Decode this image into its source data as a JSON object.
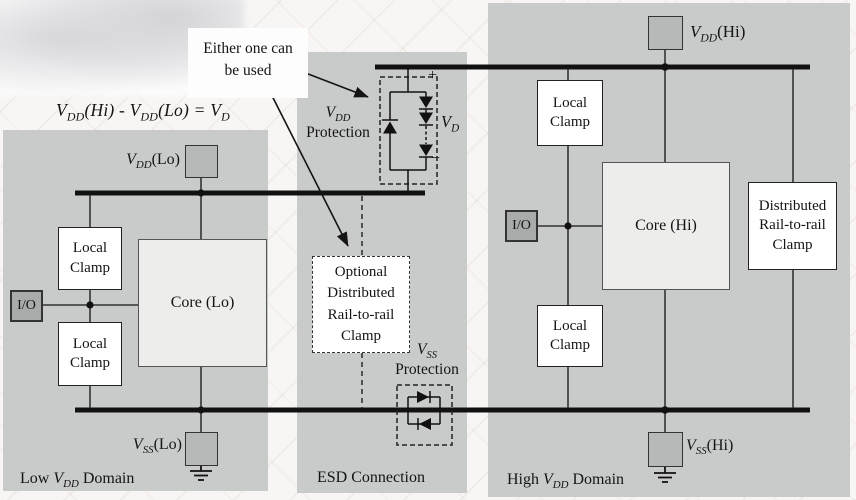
{
  "colors": {
    "panel_gray": "#c9cbca",
    "pad_gray": "#b7b9b8",
    "io_pad_gray": "#a9abaa",
    "core_fill": "#ededec",
    "line_black": "#141414",
    "box_white": "#ffffff"
  },
  "annotations": {
    "either_one": "Either one can be used",
    "formula": {
      "p1": "V",
      "s1": "DD",
      "p2": "(Hi) - ",
      "p3": "V",
      "s2": "DD",
      "p4": "(Lo) = ",
      "p5": "V",
      "s3": "D"
    }
  },
  "left_domain": {
    "domain_label": {
      "pre": "Low ",
      "v": "V",
      "sub": "DD",
      "post": " Domain"
    },
    "vdd_pad_label": {
      "v": "V",
      "sub": "DD",
      "rest": "(Lo)"
    },
    "vss_pad_label": {
      "v": "V",
      "sub": "SS",
      "rest": "(Lo)"
    },
    "io_label": "I/O",
    "core_label": "Core (Lo)",
    "local_clamp_top": "Local Clamp",
    "local_clamp_bottom": "Local Clamp"
  },
  "esd_section": {
    "section_label": "ESD Connection",
    "vdd_protection": {
      "v": "V",
      "sub": "DD",
      "line2": "Protection"
    },
    "vss_protection": {
      "v": "V",
      "sub": "SS",
      "line2": "Protection"
    },
    "vd_label": {
      "v": "V",
      "sub": "D"
    },
    "plus": "+",
    "minus": "−",
    "optional_clamp": "Optional Distributed Rail-to-rail Clamp"
  },
  "right_domain": {
    "domain_label": {
      "pre": "High ",
      "v": "V",
      "sub": "DD",
      "post": " Domain"
    },
    "vdd_pad_label": {
      "v": "V",
      "sub": "DD",
      "rest": "(Hi)"
    },
    "vss_pad_label": {
      "v": "V",
      "sub": "SS",
      "rest": "(Hi)"
    },
    "io_label": "I/O",
    "core_label": "Core (Hi)",
    "local_clamp_top": "Local Clamp",
    "local_clamp_bottom": "Local Clamp",
    "distributed_clamp": "Distributed Rail-to-rail Clamp"
  }
}
